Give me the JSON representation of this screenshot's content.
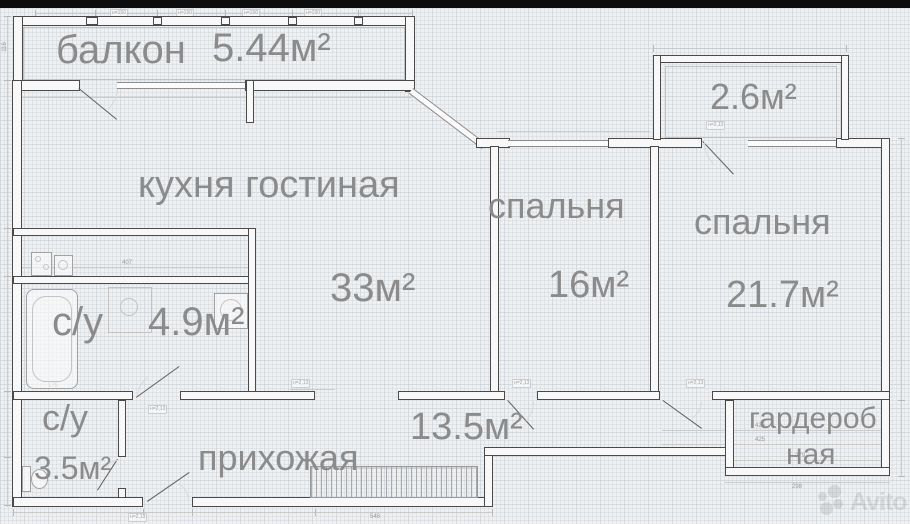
{
  "plan": {
    "rooms": {
      "balcony": {
        "name": "балкон",
        "area": "5.44м²"
      },
      "kitchen": {
        "name": "кухня гостиная",
        "area": "33м²"
      },
      "bedroom_small": {
        "name": "спальня",
        "area": "16м²"
      },
      "bedroom_large": {
        "name": "спальня",
        "area": "21.7м²"
      },
      "loggia": {
        "area": "2.6м²"
      },
      "bathroom_large": {
        "name": "с/у",
        "area": "4.9м²"
      },
      "bathroom_small": {
        "name": "с/у",
        "area": "3.5м²"
      },
      "hallway": {
        "name": "прихожая",
        "area": "13.5м²"
      },
      "wardrobe": {
        "name_line1": "гардероб",
        "name_line2": "ная"
      }
    },
    "dimensions": {
      "top_row": [
        "138",
        "120",
        "120",
        "120",
        "120",
        "102"
      ],
      "top_tags": [
        "н=150",
        "н=150",
        "н=150",
        "н=150"
      ],
      "bath_width": "407",
      "tub_width": "175",
      "corridor_a": "426",
      "corridor_b": "425",
      "wardrobe_inner": "279",
      "wardrobe_outer": "298",
      "bottom_width": "548",
      "left_height": "116",
      "door_tag": "н=2,13"
    },
    "watermark_text": "Avito"
  }
}
